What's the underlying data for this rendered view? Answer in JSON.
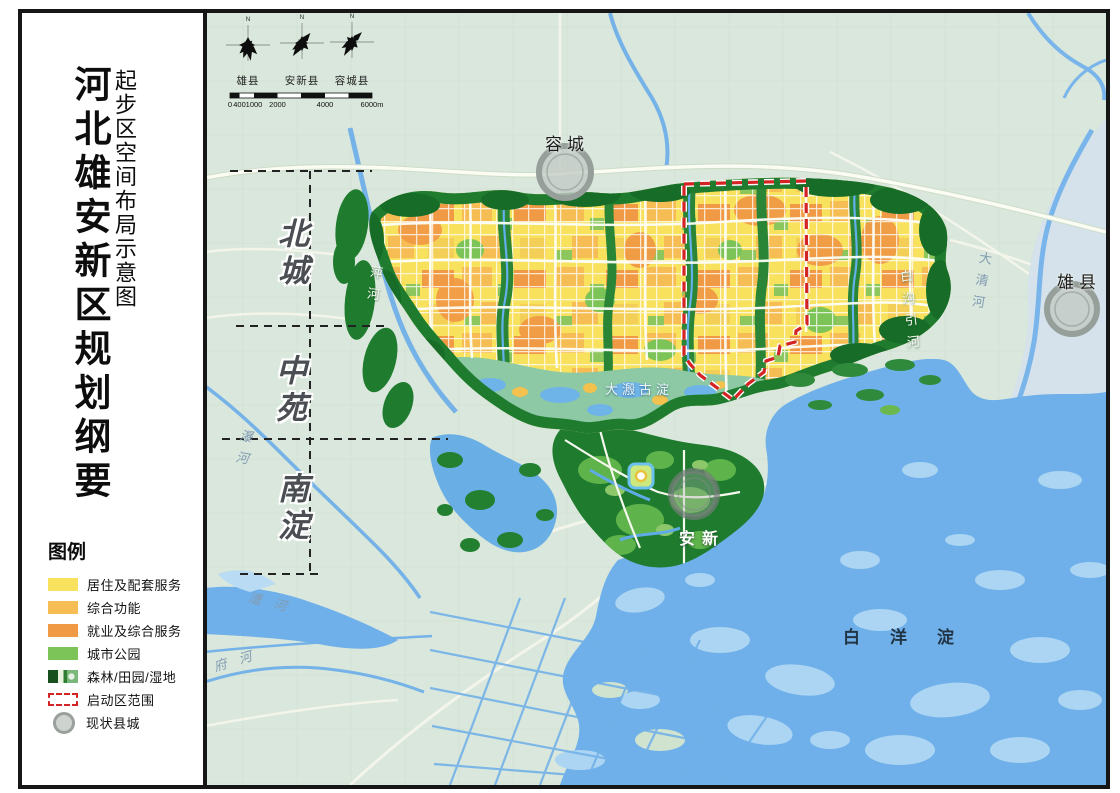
{
  "sidebar": {
    "title_main": "河北雄安新区规划纲要",
    "title_sub": "起步区空间布局示意图"
  },
  "compass": {
    "north": "N",
    "counties": [
      "雄县",
      "安新县",
      "容城县"
    ]
  },
  "scalebar": {
    "ticks": [
      "0",
      "400",
      "1000",
      "2000",
      "4000",
      "6000m"
    ]
  },
  "districts": [
    "北城",
    "中苑",
    "南淀"
  ],
  "legend": {
    "title": "图例",
    "items": [
      {
        "label": "居住及配套服务",
        "type": "swatch",
        "color": "#f8e15d"
      },
      {
        "label": "综合功能",
        "type": "swatch",
        "color": "#f6bd55"
      },
      {
        "label": "就业及综合服务",
        "type": "swatch",
        "color": "#f09a45"
      },
      {
        "label": "城市公园",
        "type": "swatch",
        "color": "#7cc457"
      },
      {
        "label": "森林/田园/湿地",
        "type": "forest",
        "color": "#1f7c2f"
      },
      {
        "label": "启动区范围",
        "type": "dashed",
        "color": "#d42323"
      },
      {
        "label": "现状县城",
        "type": "circle",
        "color": "#9aa09c"
      }
    ]
  },
  "map_labels": {
    "cities": [
      {
        "name": "容城"
      },
      {
        "name": "雄县"
      },
      {
        "name": "安新"
      }
    ],
    "lake": "白洋淀",
    "ancient_lake": "大溵古淀",
    "rivers": [
      "萍河",
      "瀑河",
      "漕河",
      "府河",
      "白沟引河",
      "大清河"
    ]
  },
  "colors": {
    "map_bg": "#d9e7dc",
    "water": "#6fb0ea",
    "island": "#abd5f2",
    "forest": "#1f7c2f",
    "residential": "#f8e15d",
    "mixed": "#f6bd55",
    "employment": "#f09a45",
    "park": "#7cc457",
    "boundary_red": "#d42323"
  }
}
